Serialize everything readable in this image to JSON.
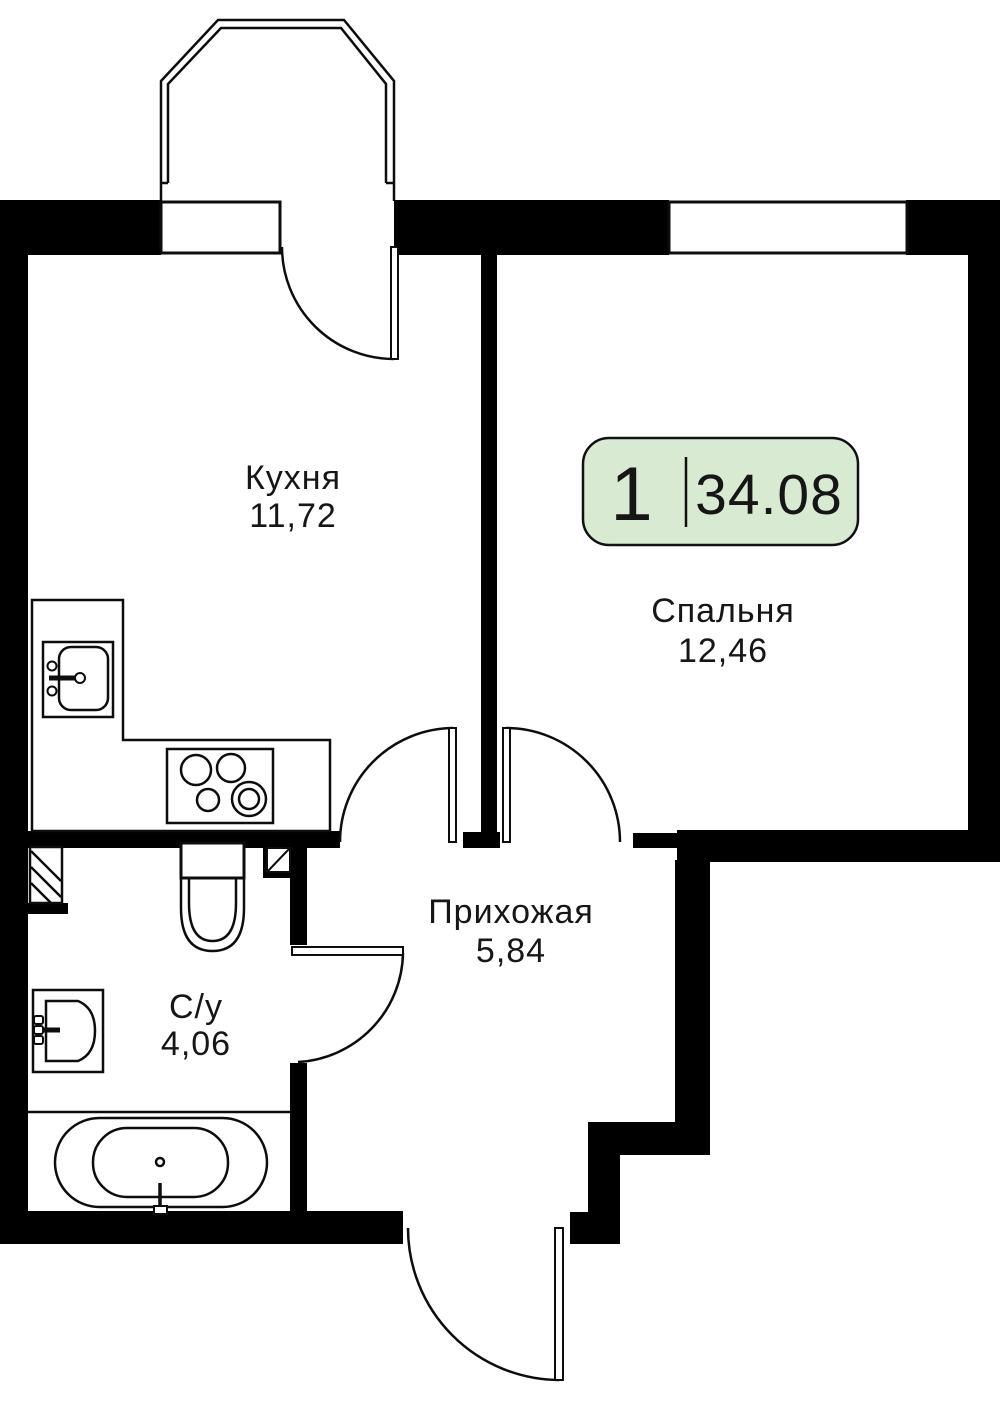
{
  "plan": {
    "badge": {
      "rooms_count": "1",
      "total_area": "34.08"
    },
    "rooms": [
      {
        "name": "Кухня",
        "area": "11,72"
      },
      {
        "name": "Спальня",
        "area": "12,46"
      },
      {
        "name": "Прихожая",
        "area": "5,84"
      },
      {
        "name": "С/у",
        "area": "4,06"
      }
    ],
    "colors": {
      "wall": "#000000",
      "line": "#0d0d0d",
      "background": "#ffffff",
      "badge_fill": "#d9ead3",
      "badge_border": "#111111",
      "text": "#161616"
    }
  }
}
